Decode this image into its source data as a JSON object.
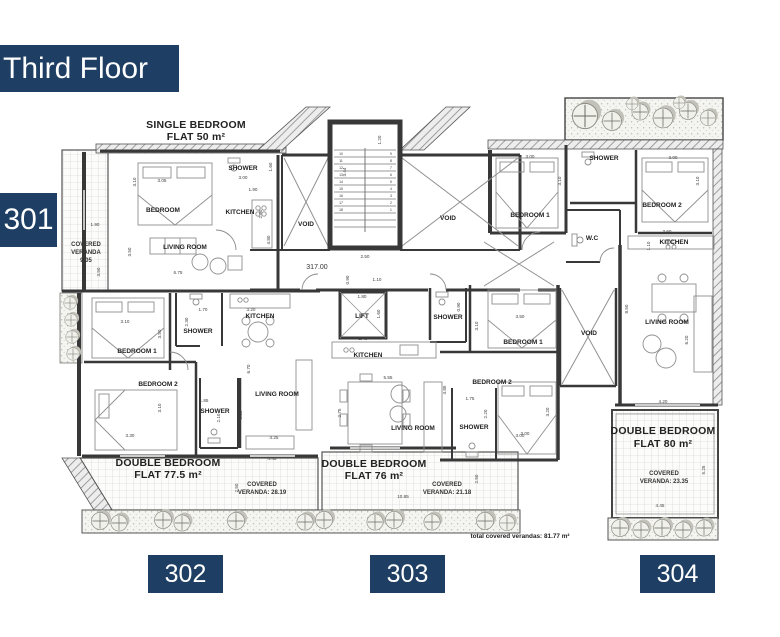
{
  "banner": {
    "title": "Third Floor"
  },
  "unit_tabs": {
    "left": "301",
    "b302": "302",
    "b303": "303",
    "b304": "304"
  },
  "flat_titles": {
    "f301_line1": "SINGLE BEDROOM",
    "f301_line2": "FLAT 50 m²",
    "f302_line1": "DOUBLE BEDROOM",
    "f302_line2": "FLAT 77.5 m²",
    "f303_line1": "DOUBLE BEDROOM",
    "f303_line2": "FLAT 76 m²",
    "f304_line1": "DOUBLE BEDROOM",
    "f304_line2": "FLAT 80 m²"
  },
  "rooms": {
    "f301_bedroom": "BEDROOM",
    "f301_shower": "SHOWER",
    "f301_kitchen": "KITCHEN",
    "f301_living": "LIVING ROOM",
    "f302_bedroom1": "BEDROOM 1",
    "f302_bedroom2": "BEDROOM 2",
    "f302_shower1": "SHOWER",
    "f302_shower2": "SHOWER",
    "f302_kitchen": "KITCHEN",
    "f302_living": "LIVING ROOM",
    "f303_kitchen": "KITCHEN",
    "f303_living": "LIVING ROOM",
    "f303_bedroom1": "BEDROOM 1",
    "f303_bedroom2": "BEDROOM 2",
    "f303_shower1": "SHOWER",
    "f303_shower2": "SHOWER",
    "f304_bedroom1": "BEDROOM 1",
    "f304_bedroom2": "BEDROOM 2",
    "f304_shower": "SHOWER",
    "f304_wc": "W.C",
    "f304_kitchen": "KITCHEN",
    "f304_living": "LIVING ROOM",
    "void_left": "VOID",
    "void_right": "VOID",
    "void_east": "VOID",
    "lift": "LIFT"
  },
  "verandas": {
    "v301_1": "COVERED",
    "v301_2": "VERANDA",
    "v301_3": "9.05",
    "v302_1": "COVERED",
    "v302_2": "VERANDA: 28.19",
    "v303_1": "COVERED",
    "v303_2": "VERANDA: 21.18",
    "v304_1": "COVERED",
    "v304_2": "VERANDA: 23.35"
  },
  "annotations": {
    "level": "317.00",
    "total": "total covered verandas: 81.77 m²"
  },
  "stair_numbers": [
    "1",
    "2",
    "3",
    "4",
    "5",
    "6",
    "7",
    "8",
    "9",
    "10",
    "11",
    "12",
    "13",
    "14",
    "15",
    "16",
    "17",
    "18"
  ],
  "dims": {
    "d01": "3.05",
    "d02": "3.10",
    "d03": "1.60",
    "d04": "3.00",
    "d05": "1.90",
    "d06": "2.50",
    "d07": "4.80",
    "d08": "3.50",
    "d09": "6.75",
    "d10": "1.90",
    "d11": "3.50",
    "d12": "1.20",
    "d13": "3.44",
    "d14": "2.50",
    "d15": "1.10",
    "d16": "0.90",
    "d17": "1.80",
    "d18": "1.60",
    "d19": "3.10",
    "d20": "3.50",
    "d21": "1.70",
    "d22": "2.30",
    "d23": "3.20",
    "d24": "3.30",
    "d25": "3.10",
    "d26": "1.85",
    "d27": "2.10",
    "d28": "4.25",
    "d29": "3.25",
    "d30": "6.70",
    "d31": "2.40",
    "d32": "5.55",
    "d33": "4.85",
    "d34": "2.75",
    "d35": "0.90",
    "d36": "3.50",
    "d37": "3.10",
    "d38": "3.00",
    "d39": "3.20",
    "d40": "1.75",
    "d41": "2.20",
    "d42": "3.00",
    "d43": "3.10",
    "d44": "3.00",
    "d45": "3.10",
    "d46": "3.60",
    "d47": "1.10",
    "d48": "8.50",
    "d49": "6.20",
    "d50": "4.20",
    "d51": "5.25",
    "d52": "4.45",
    "d53": "4.45",
    "d54": "2.50",
    "d55": "10.85",
    "d56": "2.50",
    "d57": "3.00"
  },
  "colors": {
    "navy": "#1e3f63",
    "wall": "#383838",
    "tree": "#83b07d",
    "veranda_grid": "#c9c9c9"
  }
}
